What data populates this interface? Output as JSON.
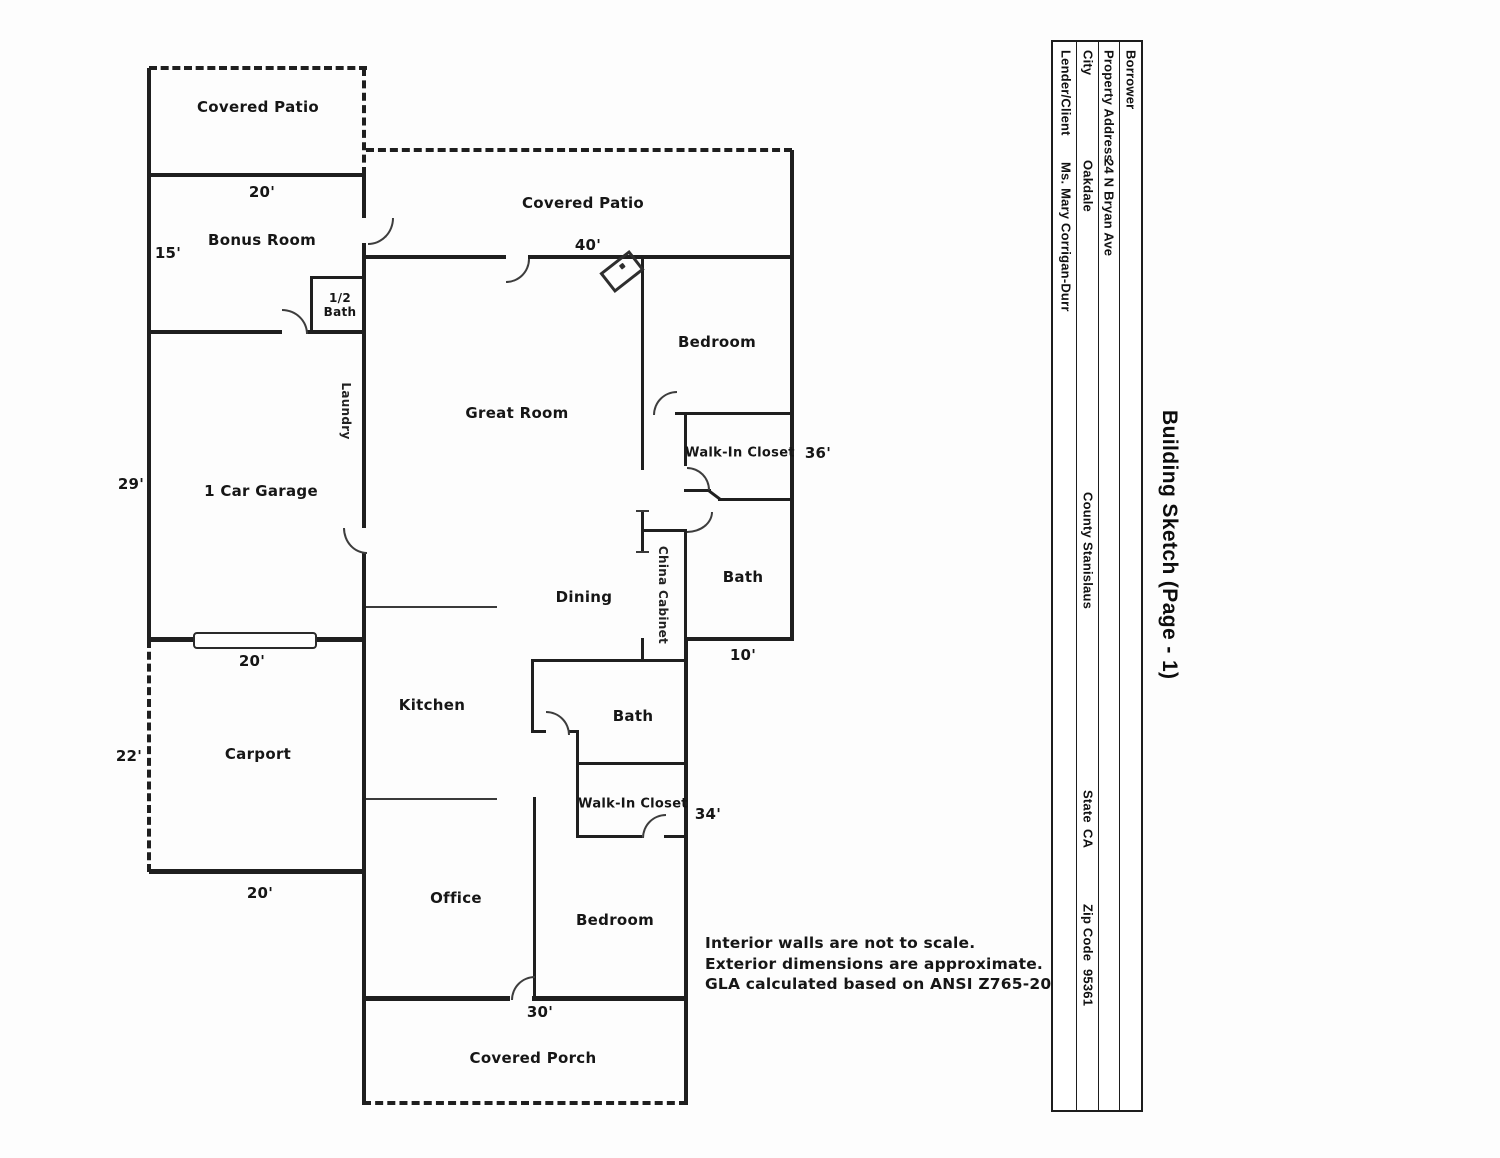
{
  "page_title": "Building Sketch (Page - 1)",
  "info_table": {
    "rows": [
      {
        "label": "Borrower",
        "value": ""
      },
      {
        "label": "Property Address",
        "value": "24 N Bryan Ave"
      },
      {
        "label": "City",
        "value": "Oakdale",
        "extra": [
          {
            "label": "County",
            "value": "Stanislaus"
          },
          {
            "label": "State",
            "value": "CA"
          },
          {
            "label": "Zip Code",
            "value": "95361"
          }
        ]
      },
      {
        "label": "Lender/Client",
        "value": "Ms. Mary Corrigan-Durr"
      }
    ]
  },
  "rooms": {
    "covered_patio_left": "Covered Patio",
    "bonus_room": "Bonus Room",
    "half_bath_top": "1/2",
    "half_bath_bottom": "Bath",
    "laundry": "Laundry",
    "garage": "1 Car Garage",
    "carport": "Carport",
    "covered_patio_top": "Covered Patio",
    "great_room": "Great Room",
    "bedroom_right": "Bedroom",
    "walk_in_closet_right": "Walk-In Closet",
    "bath_right": "Bath",
    "china_cabinet": "China Cabinet",
    "dining": "Dining",
    "kitchen": "Kitchen",
    "bath_middle": "Bath",
    "walk_in_closet_middle": "Walk-In Closet",
    "office": "Office",
    "bedroom_bottom": "Bedroom",
    "covered_porch": "Covered Porch"
  },
  "dimensions": {
    "bonus_width": "20'",
    "bonus_height": "15'",
    "garage_height": "29'",
    "garage_door_width": "20'",
    "carport_height": "22'",
    "carport_width": "20'",
    "patio_width": "40'",
    "right_height": "36'",
    "bath_width": "10'",
    "middle_height": "34'",
    "porch_width": "30'"
  },
  "notes": {
    "line1": "Interior walls are not to scale.",
    "line2": "Exterior dimensions are approximate.",
    "line3": "GLA calculated based on ANSI Z765-2021."
  },
  "colors": {
    "wall": "#1f1f1f",
    "text": "#161616"
  }
}
